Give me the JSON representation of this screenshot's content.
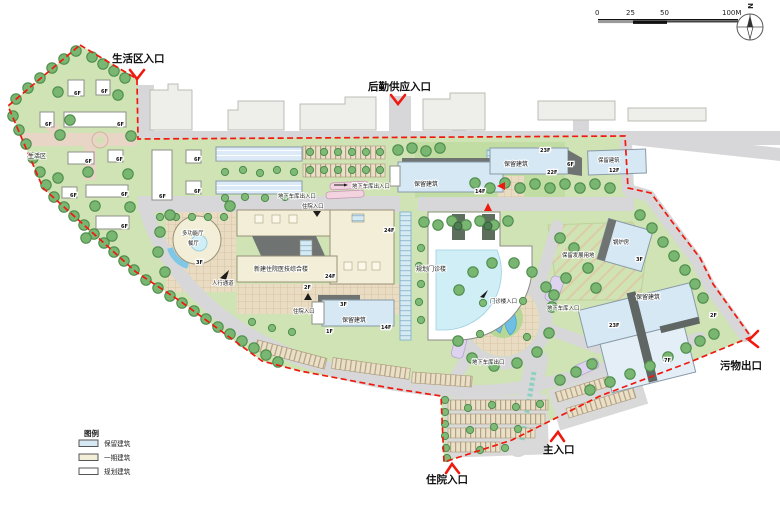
{
  "compass": {
    "label": "N"
  },
  "scalebar": {
    "t0": "0",
    "t25": "25",
    "t50": "50",
    "t100": "100M"
  },
  "legend": {
    "title": "图例",
    "items": [
      {
        "label": "保留建筑",
        "color": "#d6e8f4"
      },
      {
        "label": "一期建筑",
        "color": "#f2eed8"
      },
      {
        "label": "规划建筑",
        "color": "#ffffff"
      }
    ]
  },
  "entrances": {
    "living_label": "生活区入口",
    "logistics_label": "后勤供应入口",
    "waste_label": "污物出口",
    "main_label": "主入口",
    "inpatient_label": "住院入口"
  },
  "labels": {
    "living_area": "生活区",
    "multifunction_l1": "多功能厅",
    "multifunction_l2": "餐厅",
    "new_inpatient": "新建住院医技综合楼",
    "planned_outpatient": "规划门诊楼",
    "retained_building": "保留建筑",
    "boiler_house": "锅炉房",
    "reserved_land": "保留发展用地",
    "pedestrian_walk": "人行通道",
    "inpatient_entry": "住院入口",
    "outpatient_entry": "门诊楼入口",
    "garage_inout": "地下车库出入口",
    "garage_in": "地下车库入口",
    "garage_out": "地下车库出口"
  },
  "floors": {
    "f1": "1F",
    "f2": "2F",
    "f3": "3F",
    "f6": "6F",
    "f7": "7F",
    "f12": "12F",
    "f14": "14F",
    "f22": "22F",
    "f23": "23F",
    "f24": "24F"
  },
  "colors": {
    "boundary_red": "#f0190f",
    "site_green": "#cfe3b4",
    "road_gray": "#d7d7d9",
    "retained_blue": "#d6e8f4",
    "phase1_cream": "#f2eed8",
    "planned_white": "#ffffff"
  }
}
